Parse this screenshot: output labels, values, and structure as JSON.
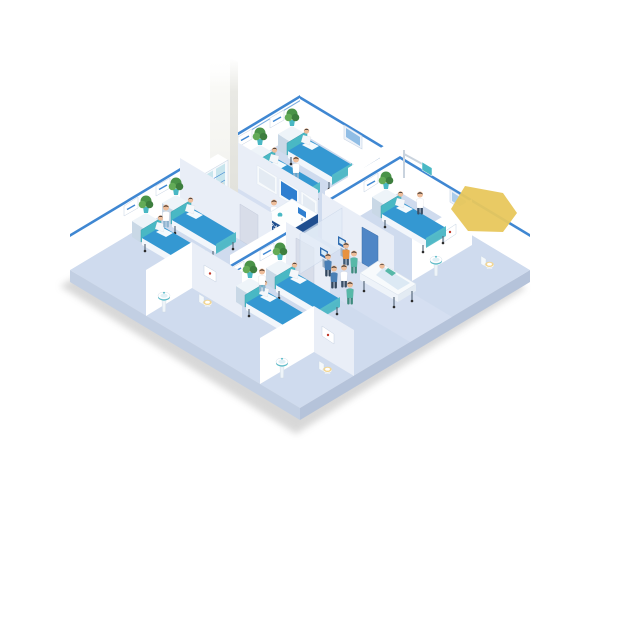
{
  "scene": {
    "type": "isometric-hospital-ward-floor-illustration",
    "reception": {
      "sign": "护士站"
    },
    "wards": [
      {
        "id": "ward-a",
        "position": "top",
        "beds": 2,
        "patients": 2,
        "nurses": 1,
        "plants": 2
      },
      {
        "id": "ward-b",
        "position": "left",
        "beds": 2,
        "patients": 2,
        "nurses": 1,
        "plants": 2,
        "bathroom": {
          "sink": 1,
          "toilet": 1
        }
      },
      {
        "id": "ward-c",
        "position": "bottom",
        "beds": 2,
        "patients": 2,
        "nurses": 1,
        "plants": 2,
        "bathroom": {
          "sink": 1,
          "toilet": 1
        }
      },
      {
        "id": "ward-d",
        "position": "right",
        "beds": 1,
        "patients": 1,
        "doctors": 1,
        "plants": 1,
        "equipment": [
          "overhead-monitor-boom"
        ],
        "bathroom": {
          "sink": 1,
          "toilet": 1
        }
      }
    ],
    "nurse_station": {
      "wall_monitors": 3,
      "reception_desk": 1,
      "staff": 2,
      "medicine_cabinet": 1
    },
    "corridor": {
      "self_service_kiosks": 2,
      "kiosk_users": 2,
      "walking_figures": 3,
      "gurney": {
        "patient": 1,
        "escort_nurse": 1
      }
    },
    "annotation": {
      "yellow_highlight": true
    }
  },
  "colors": {
    "floor": "#cfdbee",
    "floor_hall": "#d8e2f2",
    "slab_se": "#b5c3da",
    "slab_sw": "#c2cfe3",
    "wall": "#ffffff",
    "wall_shade": "#e9eef7",
    "trim": "#3f87d2",
    "bed": "#3498d2",
    "bed_dark": "#2478ab",
    "headboard": "#49b8c4",
    "plant": "#4a9348",
    "desk_dark": "#1f4e8f",
    "desk_light": "#cfe0f0",
    "door_blue": "#4f86c6",
    "door_gray": "#d8dde9",
    "glass": "#e3ecf7",
    "monitor_blue": "#2f7fd0",
    "scrubs_blue": "#4a7fb5",
    "scrubs_teal": "#57b8a8",
    "coat_white": "#ffffff",
    "skin": "#eebd9a",
    "hair": "#33302e",
    "visitor_orange": "#e8923f",
    "highlight_yellow": "#e8c75c",
    "shadow": "#909090"
  }
}
